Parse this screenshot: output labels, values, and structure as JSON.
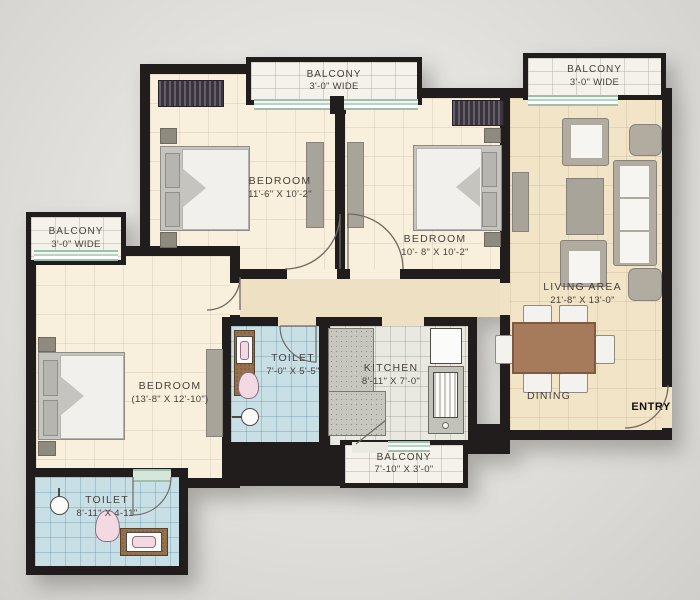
{
  "title": "2-3 BHK apartment floor plan",
  "rooms": {
    "bedroom1": {
      "name": "BEDROOM",
      "dims": "11'-6\" X 10'-2\""
    },
    "bedroom2": {
      "name": "BEDROOM",
      "dims": "10'- 8\" X 10'-2\""
    },
    "master": {
      "name": "BEDROOM",
      "dims": "(13'-8\" X 12'-10\")"
    },
    "living": {
      "name": "LIVING AREA",
      "dims": "21'-8\" X 13'-0\""
    },
    "dining": {
      "name": "DINING"
    },
    "kitchen": {
      "name": "KITCHEN",
      "dims": "8'-11\" X 7'-0\""
    },
    "toilet_center": {
      "name": "TOILET",
      "dims": "7'-0\" X 5'-5\""
    },
    "toilet_bottom": {
      "name": "TOILET",
      "dims": "8'-11\" X 4-11\""
    },
    "entry": {
      "name": "ENTRY"
    }
  },
  "balconies": {
    "top_middle": {
      "name": "BALCONY",
      "dims": "3'-0\" WIDE"
    },
    "top_right": {
      "name": "BALCONY",
      "dims": "3'-0\" WIDE"
    },
    "left": {
      "name": "BALCONY",
      "dims": "3'-0\" WIDE"
    },
    "bottom": {
      "name": "BALCONY",
      "dims": "7'-10\" X 3'-0\""
    }
  },
  "colors": {
    "wall": "#211d1d",
    "bedroom_floor": "#f8efdc",
    "living_floor": "#f2e4c6",
    "corridor_floor": "#eee0c2",
    "toilet_floor": "#c9dfe6",
    "kitchen_floor": "#e9e9e2",
    "balcony_floor": "#f4f2eb",
    "window_frame": "#9fbfae",
    "dining_table": "#a57b5b"
  }
}
